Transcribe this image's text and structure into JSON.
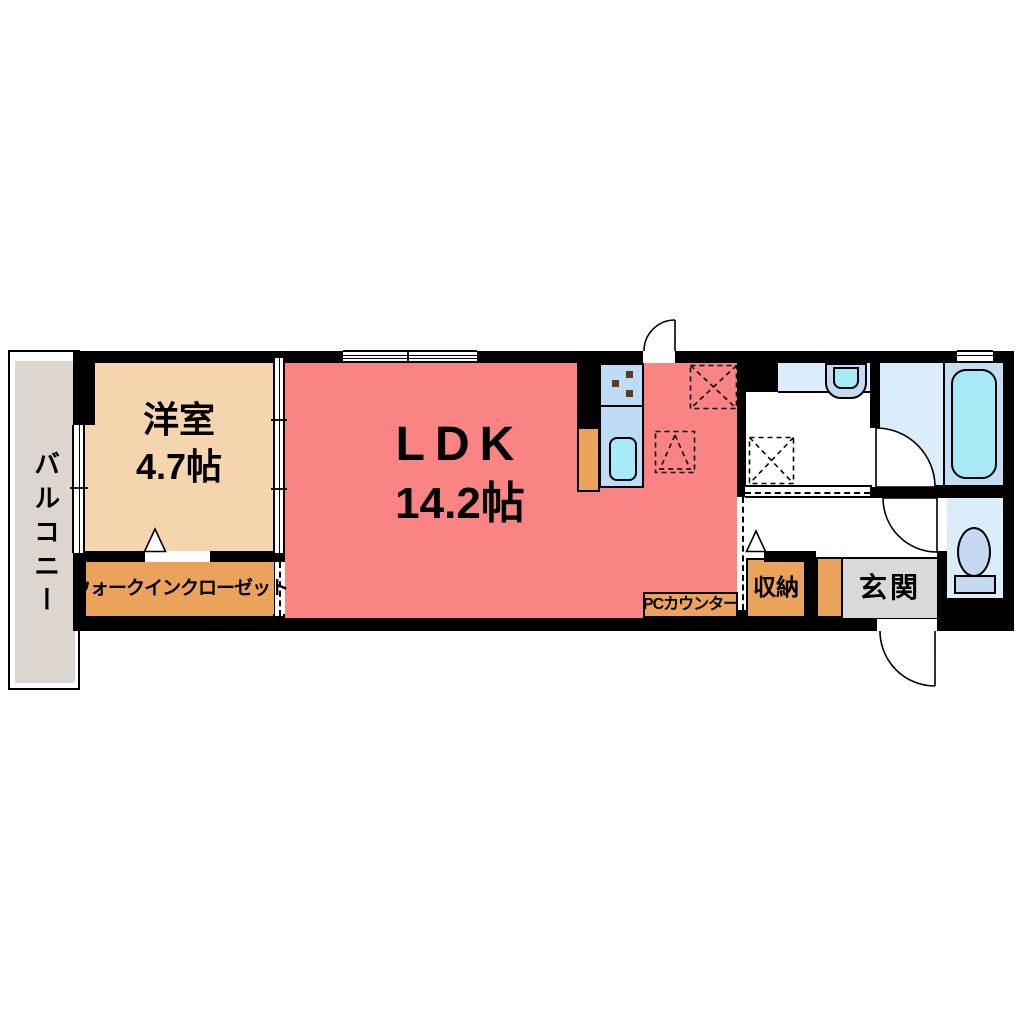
{
  "plan": {
    "balcony": {
      "label": "バルコニー"
    },
    "bedroom": {
      "label": "洋室",
      "size": "4.7帖"
    },
    "ldk": {
      "label": "LDK",
      "size": "14.2帖"
    },
    "wic": {
      "label": "ウォークインクローゼット"
    },
    "pc_counter": {
      "label": "PCカウンター"
    },
    "storage": {
      "label": "収納"
    },
    "entrance": {
      "label": "玄関"
    }
  },
  "fixtures": [
    "kitchen-counter",
    "stove-burners",
    "kitchen-sink",
    "refrigerator-space",
    "range-hood-space",
    "washing-machine-space",
    "wash-basin",
    "bathtub",
    "toilet",
    "swing-doors",
    "sliding-doors",
    "windows",
    "opening-markers"
  ],
  "colors": {
    "wall": "#000000",
    "ldk_fill": "#fa8383",
    "bedroom_fill": "#f5d5ad",
    "orange_fill": "#eba35c",
    "balcony_fill": "#dcd6cf",
    "entrance_fill": "#d9d9d9",
    "counter_blue": "#bedcf5",
    "room_blue": "#dbecfa",
    "tub_zone_blue": "#c3def3",
    "water_cyan": "#a7e9f4",
    "toilet_blue": "#c5daf2",
    "burner_brown": "#5f3a1e"
  }
}
